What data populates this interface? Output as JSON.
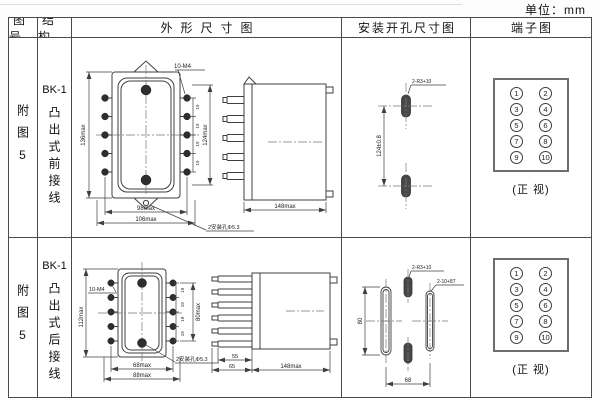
{
  "unit_label": "单位：mm",
  "header": {
    "figure": "图号",
    "structure": "结构",
    "outline": "外形尺寸图",
    "mounting": "安装开孔尺寸图",
    "terminal": "端子图"
  },
  "rows": [
    {
      "figure": "附图5",
      "model": "BK-1",
      "structure": "凸出式前接线",
      "outline": {
        "height_outer": "136max",
        "screw_note": "10-M4",
        "pitch": "19",
        "height_screws": "124max",
        "width_inner": "98max",
        "width_outer": "106max",
        "hole_note": "2安装孔Φ5.3",
        "depth": "148max"
      },
      "mounting": {
        "slot_note": "2-R3+10",
        "vertical": "124±0.8"
      },
      "terminal": {
        "numbers": [
          "1",
          "2",
          "3",
          "4",
          "5",
          "6",
          "7",
          "8",
          "9",
          "10"
        ],
        "view": "(正 视)"
      }
    },
    {
      "figure": "附图5",
      "model": "BK-1",
      "structure": "凸出式后接线",
      "outline": {
        "screw_note": "10-M4",
        "height_outer": "112max",
        "pitch": "19",
        "height_screws": "80max",
        "width_inner": "68max",
        "width_outer": "88max",
        "hole_note": "2安装孔Φ5.3",
        "pin_inner": "55",
        "pin_outer": "65",
        "depth": "148max"
      },
      "mounting": {
        "slot_note_small": "2-R3+10",
        "slot_note_long": "2-10+87",
        "vertical": "80",
        "horizontal": "68"
      },
      "terminal": {
        "numbers": [
          "1",
          "2",
          "3",
          "4",
          "5",
          "6",
          "7",
          "8",
          "9",
          "10"
        ],
        "view": "(正 视)"
      }
    }
  ]
}
